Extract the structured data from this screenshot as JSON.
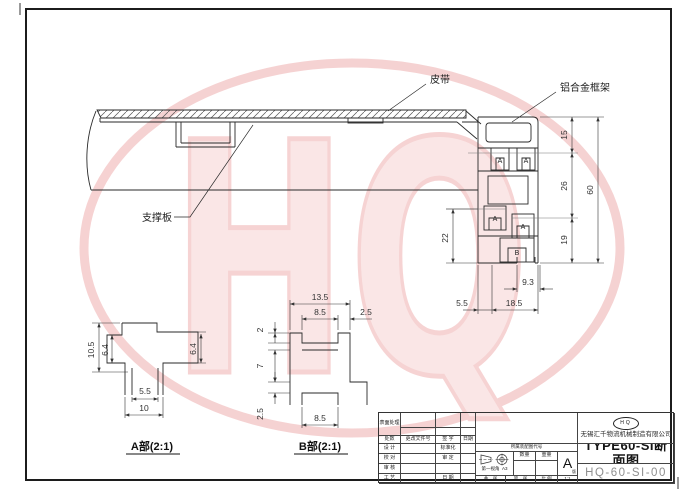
{
  "watermark": {
    "text": "HQ",
    "ring_color": "#eb9c9c",
    "fill_color": "#f6caca"
  },
  "main_view": {
    "belt_label": "皮带",
    "frame_label": "铝合金框架",
    "support_label": "支撑板",
    "slot_marks": [
      "A",
      "A",
      "A",
      "A",
      "B"
    ],
    "dims": {
      "h_top": "15",
      "h_mid": "26",
      "h_bot": "19",
      "h_total": "60",
      "h_left": "22",
      "w_slot": "9.3",
      "w_off": "5.5",
      "w_bot": "18.5"
    }
  },
  "detail_a": {
    "title": "A部(2:1)",
    "dims": {
      "height": "10.5",
      "left": "6.4",
      "right": "6.4",
      "inner": "5.5",
      "outer": "10"
    }
  },
  "detail_b": {
    "title": "B部(2:1)",
    "dims": {
      "width": "13.5",
      "opening_top": "8.5",
      "lip_right": "2.5",
      "lip_top": "2",
      "mid": "7",
      "lip_bottom": "2.5",
      "opening_bottom": "8.5"
    }
  },
  "title_block": {
    "surface_treatment": "表面处理",
    "change_headers": [
      "处数",
      "更改文件号",
      "签 字",
      "日期"
    ],
    "approval_rows": [
      "设 计",
      "校 对",
      "审 核",
      "工 艺"
    ],
    "std_rows": [
      "标准化",
      "审 定",
      "",
      "日 期"
    ],
    "belongs_label": "所属装配图代号",
    "projection": "第一视角",
    "paper": "A3",
    "qty": "数量",
    "weight": "重量",
    "rev": "A",
    "rev_sub": "版",
    "sheets_total": "共　张",
    "sheet_no": "第　张",
    "scale_label": "比 例",
    "scale_value": "1:1",
    "logo": "HQ",
    "company": "无锡汇千物流机械制造有限公司",
    "drawing_title": "TYPE60-SI断面图",
    "drawing_no": "HQ-60-SI-00"
  }
}
